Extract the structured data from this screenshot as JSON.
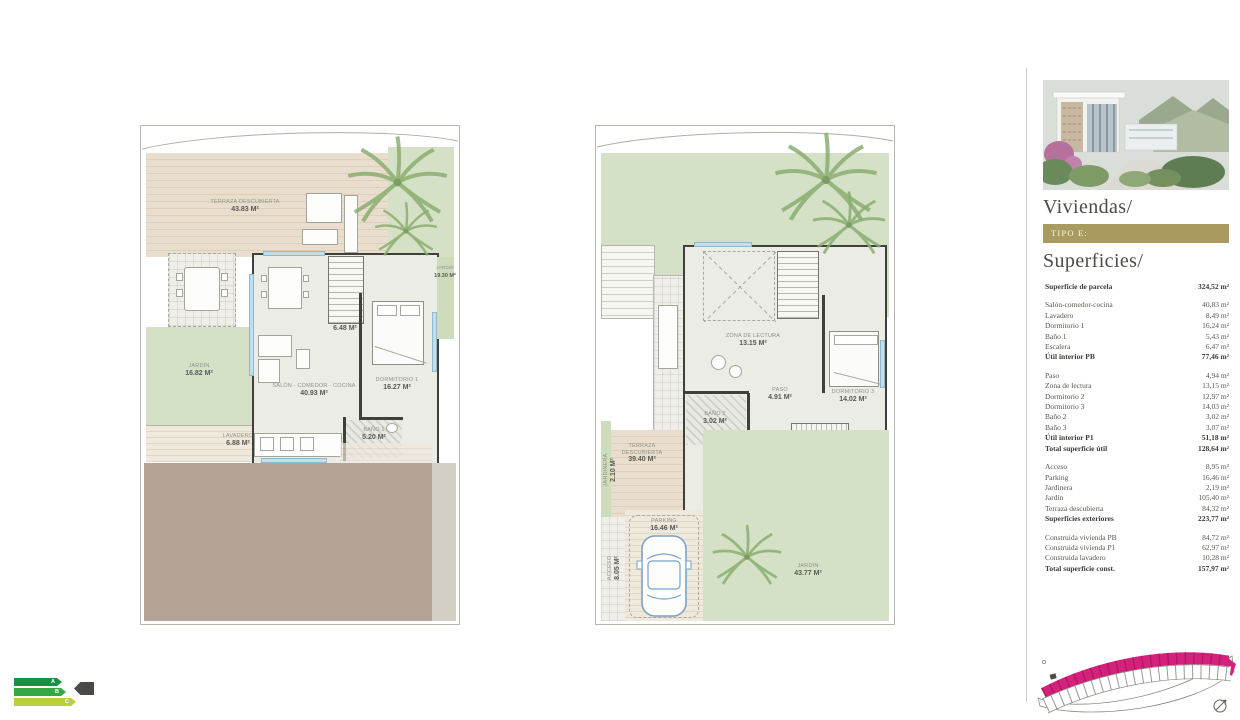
{
  "colors": {
    "accent_magenta": "#d6217c",
    "gold": "#a99b60",
    "grass_green": "#d5e1c6",
    "deck_beige": "#e9decd",
    "terrain_brown": "#b3a496",
    "wall_dark": "#3f3f3b",
    "window_blue": "#bfdfec",
    "energy_a": "#169245",
    "energy_b": "#35a845",
    "energy_c": "#b9cf3c"
  },
  "sidebar": {
    "title": "Viviendas/",
    "type_badge": "TIPO E:",
    "subtitle": "Superficies/",
    "surfaces": [
      {
        "label": "Superficie de parcela",
        "value": "324,52 m²",
        "cls": "bold"
      },
      {
        "label": "Salón-comedor-cocina",
        "value": "40,83 m²",
        "cls": "gap"
      },
      {
        "label": "Lavadero",
        "value": "8,49 m²",
        "cls": ""
      },
      {
        "label": "Dormitorio 1",
        "value": "16,24 m²",
        "cls": ""
      },
      {
        "label": "Baño 1",
        "value": "5,43 m²",
        "cls": ""
      },
      {
        "label": "Escalera",
        "value": "6,47 m²",
        "cls": ""
      },
      {
        "label": "Útil interior PB",
        "value": "77,46 m²",
        "cls": "bold"
      },
      {
        "label": "Paso",
        "value": "4,94 m²",
        "cls": "gap"
      },
      {
        "label": "Zona de lectura",
        "value": "13,15 m²",
        "cls": ""
      },
      {
        "label": "Dormitorio 2",
        "value": "12,97 m²",
        "cls": ""
      },
      {
        "label": "Dormitorio 3",
        "value": "14,03 m²",
        "cls": ""
      },
      {
        "label": "Baño 2",
        "value": "3,02 m²",
        "cls": ""
      },
      {
        "label": "Baño 3",
        "value": "3,07 m²",
        "cls": ""
      },
      {
        "label": "Útil interior P1",
        "value": "51,18 m²",
        "cls": "bold"
      },
      {
        "label": "Total superficie útil",
        "value": "128,64 m²",
        "cls": "bold"
      },
      {
        "label": "Acceso",
        "value": "8,95 m²",
        "cls": "gap"
      },
      {
        "label": "Parking",
        "value": "16,46 m²",
        "cls": ""
      },
      {
        "label": "Jardinera",
        "value": "2,19 m²",
        "cls": ""
      },
      {
        "label": "Jardín",
        "value": "105,40 m²",
        "cls": ""
      },
      {
        "label": "Terraza descubierta",
        "value": "84,32 m²",
        "cls": ""
      },
      {
        "label": "Superficies exteriores",
        "value": "223,77 m²",
        "cls": "bold"
      },
      {
        "label": "Construida vivienda PB",
        "value": "84,72 m²",
        "cls": "gap"
      },
      {
        "label": "Construida vivienda P1",
        "value": "62,97 m²",
        "cls": ""
      },
      {
        "label": "Construida lavadero",
        "value": "10,28 m²",
        "cls": ""
      },
      {
        "label": "Total superficie const.",
        "value": "157,97 m²",
        "cls": "bold"
      }
    ]
  },
  "plans": {
    "pb": {
      "terraza": {
        "name": "TERRAZA DESCUBIERTA",
        "area": "43.83 m²"
      },
      "jardin_right": {
        "name": "JARDÍN",
        "area": "19.30 m²"
      },
      "jardin_left": {
        "name": "JARDÍN",
        "area": "16.82 m²"
      },
      "lavadero": {
        "name": "LAVADERO",
        "area": "6.88 m²"
      },
      "salon": {
        "name": "SALÓN - COMEDOR - COCINA",
        "area": "40.93 m²"
      },
      "dormitorio1": {
        "name": "DORMITORIO 1",
        "area": "16.27 m²"
      },
      "bano1": {
        "name": "BAÑO 1",
        "area": "5.20 m²"
      },
      "escalera": {
        "area": "6.48 m²"
      }
    },
    "p1": {
      "zona_lectura": {
        "name": "ZONA DE LECTURA",
        "area": "13.15 m²"
      },
      "paso": {
        "name": "PASO",
        "area": "4.91 m²"
      },
      "dormitorio3": {
        "name": "DORMITORIO 3",
        "area": "14.02 m²"
      },
      "bano2": {
        "name": "BAÑO 2",
        "area": "3.02 m²"
      },
      "dormitorio2": {
        "name": "DORMITORIO 2",
        "area": "13.17 m²"
      },
      "bano3": {
        "name": "BAÑO 3",
        "area": "3.07 m²"
      },
      "terraza": {
        "name": "TERRAZA DESCUBIERTA",
        "area": "39.40 m²"
      },
      "jardinera": {
        "name": "JARDINERA",
        "area": "2.10 m²"
      },
      "acceso": {
        "name": "ACCESO",
        "area": "8.05 m²"
      },
      "parking": {
        "name": "PARKING",
        "area": "16.46 m²"
      },
      "jardin": {
        "name": "JARDÍN",
        "area": "43.77 m²"
      }
    }
  },
  "energy": {
    "a": "A",
    "b": "B",
    "c": "C"
  }
}
